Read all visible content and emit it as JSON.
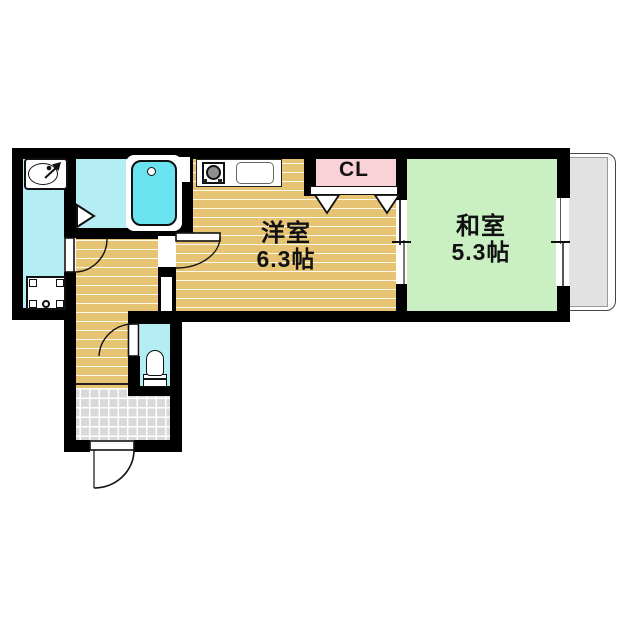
{
  "floorplan": {
    "labels": {
      "western_room_name": "洋室",
      "western_room_size": "6.3帖",
      "japanese_room_name": "和室",
      "japanese_room_size": "5.3帖",
      "closet_label": "CL"
    },
    "colors": {
      "wood_floor": "#e7c473",
      "tatami_green": "#c9efc3",
      "wet_area_cyan": "#b4eef4",
      "bathtub_cyan": "#68e3ef",
      "closet_pink": "#f9d2d8",
      "entrance_tile": "#d9d9d9",
      "balcony_gray": "#e2e2e2",
      "wall": "#000000"
    },
    "fixtures": [
      "bathtub",
      "wash-basin",
      "washing-machine-pan",
      "kitchen-stove",
      "kitchen-sink",
      "toilet",
      "closet-folding-doors",
      "sliding-partition",
      "balcony-window",
      "entrance-door",
      "pipe-space"
    ]
  }
}
